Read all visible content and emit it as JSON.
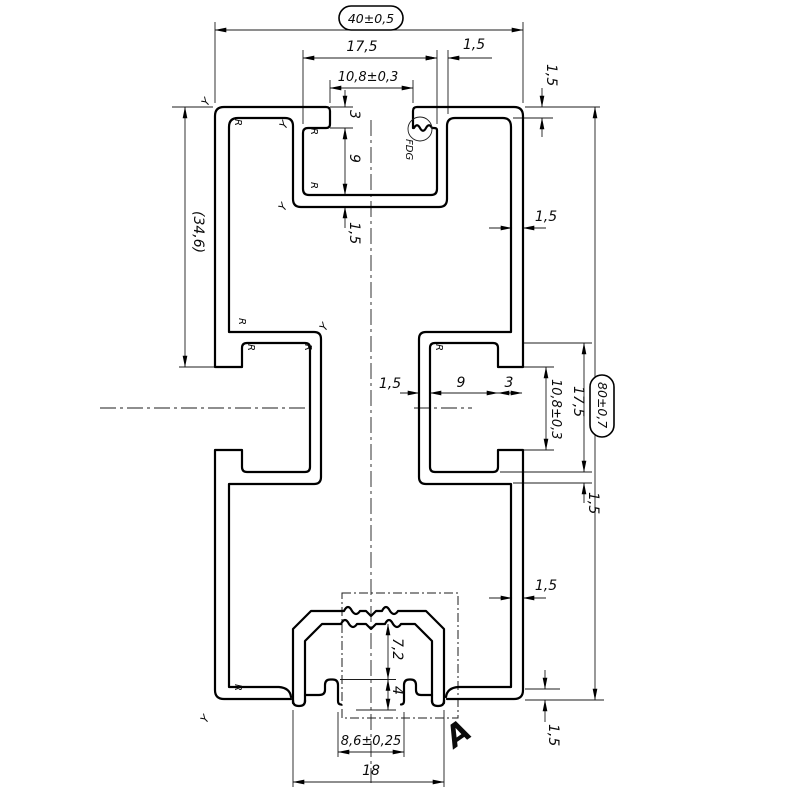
{
  "drawing": {
    "dims": {
      "overall_width": "40±0,5",
      "overall_height": "80±0,7",
      "slot_inner": "17,5",
      "slot_opening": "10,8±0,3",
      "wall": "1,5",
      "lip_depth": "3",
      "slot_depth": "9",
      "ref_height": "(34,6)",
      "groove_depth": "7,2",
      "hook_height": "4",
      "bottom_opening": "8,6±0,25",
      "bottom_width": "18"
    },
    "labels": {
      "detail": "A",
      "note": "FDG",
      "radius": "R",
      "edge": "Y"
    }
  }
}
